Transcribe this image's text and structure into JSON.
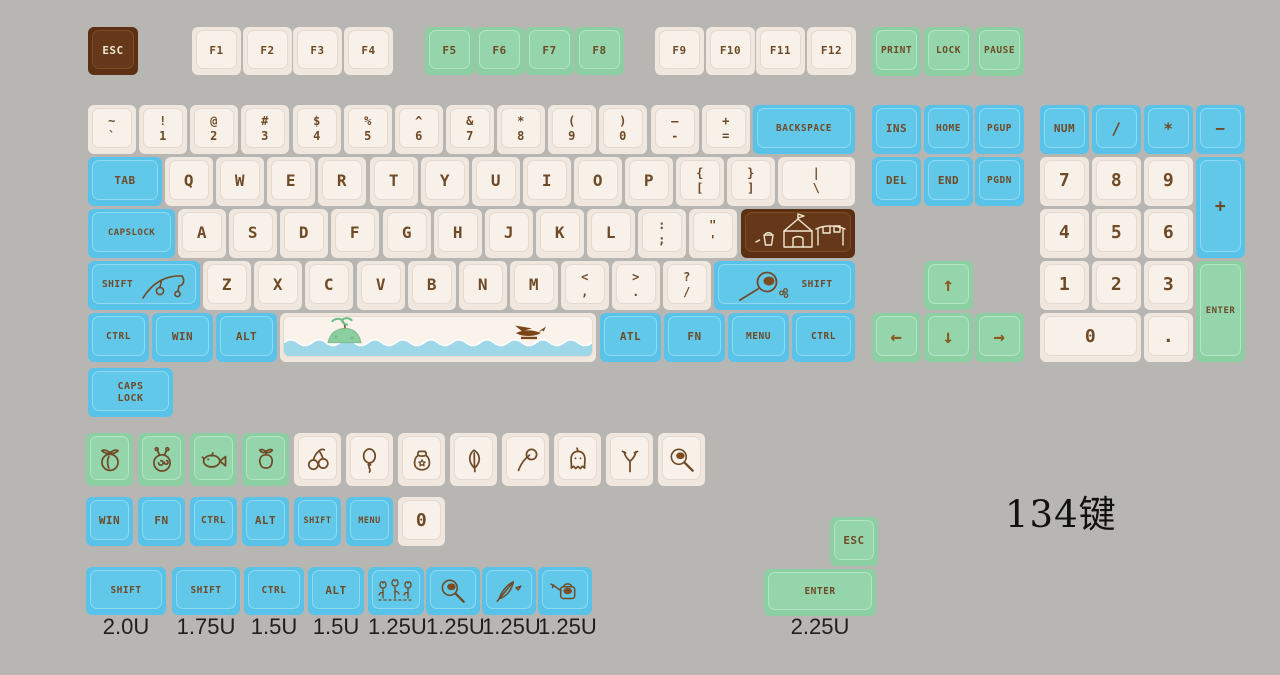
{
  "title": "134键",
  "palette": {
    "background": "#b8b6b3",
    "cream_key": "#f0e7df",
    "blue_key": "#58c2e8",
    "green_key": "#8bcfa2",
    "brown_key": "#5c3012",
    "legend_brown": "#6f4a26",
    "legend_cream": "#f0e5cf"
  },
  "keys": [
    {
      "n": "key-esc",
      "t": "ESC",
      "c": "brown",
      "x": 88,
      "y": 27,
      "w": 50,
      "h": 48
    },
    {
      "t": "F1",
      "c": "cream",
      "x": 192,
      "y": 27,
      "w": 49,
      "h": 48
    },
    {
      "t": "F2",
      "c": "cream",
      "x": 243,
      "y": 27,
      "w": 49,
      "h": 48
    },
    {
      "t": "F3",
      "c": "cream",
      "x": 293,
      "y": 27,
      "w": 49,
      "h": 48
    },
    {
      "t": "F4",
      "c": "cream",
      "x": 344,
      "y": 27,
      "w": 49,
      "h": 48
    },
    {
      "t": "F5",
      "c": "green",
      "x": 425,
      "y": 27,
      "w": 49,
      "h": 48
    },
    {
      "t": "F6",
      "c": "green",
      "x": 475,
      "y": 27,
      "w": 49,
      "h": 48
    },
    {
      "t": "F7",
      "c": "green",
      "x": 525,
      "y": 27,
      "w": 49,
      "h": 48
    },
    {
      "t": "F8",
      "c": "green",
      "x": 575,
      "y": 27,
      "w": 49,
      "h": 48
    },
    {
      "t": "F9",
      "c": "cream",
      "x": 655,
      "y": 27,
      "w": 49,
      "h": 48
    },
    {
      "t": "F10",
      "c": "cream",
      "x": 706,
      "y": 27,
      "w": 49,
      "h": 48
    },
    {
      "t": "F11",
      "c": "cream",
      "x": 756,
      "y": 27,
      "w": 49,
      "h": 48
    },
    {
      "t": "F12",
      "c": "cream",
      "x": 807,
      "y": 27,
      "w": 49,
      "h": 48
    },
    {
      "t": "PRINT",
      "c": "green",
      "x": 872,
      "y": 27,
      "w": 49,
      "h": 49
    },
    {
      "t": "LOCK",
      "c": "green",
      "x": 924,
      "y": 27,
      "w": 49,
      "h": 49
    },
    {
      "t": "PAUSE",
      "c": "green",
      "x": 975,
      "y": 27,
      "w": 49,
      "h": 49
    },
    {
      "n": "key-grave",
      "top": "~",
      "bot": "`",
      "c": "cream",
      "x": 88,
      "y": 105,
      "w": 48,
      "h": 49
    },
    {
      "n": "key-1",
      "top": "!",
      "bot": "1",
      "c": "cream",
      "x": 139,
      "y": 105,
      "w": 48,
      "h": 49
    },
    {
      "n": "key-2",
      "top": "@",
      "bot": "2",
      "c": "cream",
      "x": 190,
      "y": 105,
      "w": 48,
      "h": 49
    },
    {
      "n": "key-3",
      "top": "#",
      "bot": "3",
      "c": "cream",
      "x": 241,
      "y": 105,
      "w": 48,
      "h": 49
    },
    {
      "n": "key-4",
      "top": "$",
      "bot": "4",
      "c": "cream",
      "x": 293,
      "y": 105,
      "w": 48,
      "h": 49
    },
    {
      "n": "key-5",
      "top": "%",
      "bot": "5",
      "c": "cream",
      "x": 344,
      "y": 105,
      "w": 48,
      "h": 49
    },
    {
      "n": "key-6",
      "top": "^",
      "bot": "6",
      "c": "cream",
      "x": 395,
      "y": 105,
      "w": 48,
      "h": 49
    },
    {
      "n": "key-7",
      "top": "&",
      "bot": "7",
      "c": "cream",
      "x": 446,
      "y": 105,
      "w": 48,
      "h": 49
    },
    {
      "n": "key-8",
      "top": "*",
      "bot": "8",
      "c": "cream",
      "x": 497,
      "y": 105,
      "w": 48,
      "h": 49
    },
    {
      "n": "key-9",
      "top": "(",
      "bot": "9",
      "c": "cream",
      "x": 548,
      "y": 105,
      "w": 48,
      "h": 49
    },
    {
      "n": "key-0",
      "top": ")",
      "bot": "0",
      "c": "cream",
      "x": 599,
      "y": 105,
      "w": 48,
      "h": 49
    },
    {
      "n": "key-minus",
      "top": "–",
      "bot": "-",
      "c": "cream",
      "x": 651,
      "y": 105,
      "w": 48,
      "h": 49
    },
    {
      "n": "key-equals",
      "top": "+",
      "bot": "=",
      "c": "cream",
      "x": 702,
      "y": 105,
      "w": 48,
      "h": 49
    },
    {
      "t": "BACKSPACE",
      "c": "blue",
      "x": 753,
      "y": 105,
      "w": 102,
      "h": 49
    },
    {
      "t": "TAB",
      "c": "blue",
      "x": 88,
      "y": 157,
      "w": 74,
      "h": 49
    },
    {
      "t": "Q",
      "c": "cream",
      "x": 165,
      "y": 157,
      "w": 48,
      "h": 49
    },
    {
      "t": "W",
      "c": "cream",
      "x": 216,
      "y": 157,
      "w": 48,
      "h": 49
    },
    {
      "t": "E",
      "c": "cream",
      "x": 267,
      "y": 157,
      "w": 48,
      "h": 49
    },
    {
      "t": "R",
      "c": "cream",
      "x": 318,
      "y": 157,
      "w": 48,
      "h": 49
    },
    {
      "t": "T",
      "c": "cream",
      "x": 370,
      "y": 157,
      "w": 48,
      "h": 49
    },
    {
      "t": "Y",
      "c": "cream",
      "x": 421,
      "y": 157,
      "w": 48,
      "h": 49
    },
    {
      "t": "U",
      "c": "cream",
      "x": 472,
      "y": 157,
      "w": 48,
      "h": 49
    },
    {
      "t": "I",
      "c": "cream",
      "x": 523,
      "y": 157,
      "w": 48,
      "h": 49
    },
    {
      "t": "O",
      "c": "cream",
      "x": 574,
      "y": 157,
      "w": 48,
      "h": 49
    },
    {
      "t": "P",
      "c": "cream",
      "x": 625,
      "y": 157,
      "w": 48,
      "h": 49
    },
    {
      "n": "key-bracket-open",
      "top": "{",
      "bot": "[",
      "c": "cream",
      "x": 676,
      "y": 157,
      "w": 48,
      "h": 49
    },
    {
      "n": "key-bracket-close",
      "top": "}",
      "bot": "]",
      "c": "cream",
      "x": 727,
      "y": 157,
      "w": 48,
      "h": 49
    },
    {
      "n": "key-backslash",
      "top": "|",
      "bot": "\\",
      "c": "cream",
      "x": 778,
      "y": 157,
      "w": 77,
      "h": 49
    },
    {
      "t": "CAPSLOCK",
      "c": "blue",
      "x": 88,
      "y": 209,
      "w": 87,
      "h": 49,
      "fs": 9
    },
    {
      "t": "A",
      "c": "cream",
      "x": 178,
      "y": 209,
      "w": 48,
      "h": 49
    },
    {
      "t": "S",
      "c": "cream",
      "x": 229,
      "y": 209,
      "w": 48,
      "h": 49
    },
    {
      "t": "D",
      "c": "cream",
      "x": 280,
      "y": 209,
      "w": 48,
      "h": 49
    },
    {
      "t": "F",
      "c": "cream",
      "x": 331,
      "y": 209,
      "w": 48,
      "h": 49
    },
    {
      "t": "G",
      "c": "cream",
      "x": 383,
      "y": 209,
      "w": 48,
      "h": 49
    },
    {
      "t": "H",
      "c": "cream",
      "x": 434,
      "y": 209,
      "w": 48,
      "h": 49
    },
    {
      "t": "J",
      "c": "cream",
      "x": 485,
      "y": 209,
      "w": 48,
      "h": 49
    },
    {
      "t": "K",
      "c": "cream",
      "x": 536,
      "y": 209,
      "w": 48,
      "h": 49
    },
    {
      "t": "L",
      "c": "cream",
      "x": 587,
      "y": 209,
      "w": 48,
      "h": 49
    },
    {
      "n": "key-semicolon",
      "top": ":",
      "bot": ";",
      "c": "cream",
      "x": 638,
      "y": 209,
      "w": 48,
      "h": 49
    },
    {
      "n": "key-quote",
      "top": "\"",
      "bot": "'",
      "c": "cream",
      "x": 689,
      "y": 209,
      "w": 48,
      "h": 49
    },
    {
      "n": "key-enter-iso",
      "art": "house-scene",
      "c": "brown",
      "x": 741,
      "y": 209,
      "w": 114,
      "h": 49
    },
    {
      "n": "key-shift-left",
      "t": "SHIFT",
      "icon": "fishing-rod-icon",
      "c": "blue",
      "x": 88,
      "y": 261,
      "w": 112,
      "h": 49
    },
    {
      "t": "Z",
      "c": "cream",
      "x": 203,
      "y": 261,
      "w": 48,
      "h": 49
    },
    {
      "t": "X",
      "c": "cream",
      "x": 254,
      "y": 261,
      "w": 48,
      "h": 49
    },
    {
      "t": "C",
      "c": "cream",
      "x": 305,
      "y": 261,
      "w": 48,
      "h": 49
    },
    {
      "t": "V",
      "c": "cream",
      "x": 357,
      "y": 261,
      "w": 48,
      "h": 49
    },
    {
      "t": "B",
      "c": "cream",
      "x": 408,
      "y": 261,
      "w": 48,
      "h": 49
    },
    {
      "t": "N",
      "c": "cream",
      "x": 459,
      "y": 261,
      "w": 48,
      "h": 49
    },
    {
      "t": "M",
      "c": "cream",
      "x": 510,
      "y": 261,
      "w": 48,
      "h": 49
    },
    {
      "n": "key-comma",
      "top": "<",
      "bot": ",",
      "c": "cream",
      "x": 561,
      "y": 261,
      "w": 48,
      "h": 49
    },
    {
      "n": "key-period",
      "top": ">",
      "bot": ".",
      "c": "cream",
      "x": 612,
      "y": 261,
      "w": 48,
      "h": 49
    },
    {
      "n": "key-slash",
      "top": "?",
      "bot": "/",
      "c": "cream",
      "x": 663,
      "y": 261,
      "w": 48,
      "h": 49
    },
    {
      "n": "key-shift-right",
      "t": "SHIFT",
      "icon": "net-icon",
      "iconside": "left",
      "c": "blue",
      "x": 714,
      "y": 261,
      "w": 141,
      "h": 49
    },
    {
      "t": "CTRL",
      "c": "blue",
      "x": 88,
      "y": 313,
      "w": 61,
      "h": 49
    },
    {
      "t": "WIN",
      "c": "blue",
      "x": 152,
      "y": 313,
      "w": 61,
      "h": 49
    },
    {
      "t": "ALT",
      "c": "blue",
      "x": 216,
      "y": 313,
      "w": 61,
      "h": 49
    },
    {
      "n": "key-space",
      "art": "island-scene",
      "c": "cream",
      "x": 280,
      "y": 313,
      "w": 316,
      "h": 49
    },
    {
      "t": "ATL",
      "c": "blue",
      "x": 600,
      "y": 313,
      "w": 61,
      "h": 49
    },
    {
      "t": "FN",
      "c": "blue",
      "x": 664,
      "y": 313,
      "w": 61,
      "h": 49
    },
    {
      "t": "MENU",
      "c": "blue",
      "x": 728,
      "y": 313,
      "w": 61,
      "h": 49
    },
    {
      "t": "CTRL",
      "c": "blue",
      "x": 792,
      "y": 313,
      "w": 63,
      "h": 49
    },
    {
      "t": "INS",
      "c": "blue",
      "x": 872,
      "y": 105,
      "w": 49,
      "h": 49
    },
    {
      "t": "HOME",
      "c": "blue",
      "x": 924,
      "y": 105,
      "w": 49,
      "h": 49
    },
    {
      "t": "PGUP",
      "c": "blue",
      "x": 975,
      "y": 105,
      "w": 49,
      "h": 49
    },
    {
      "t": "DEL",
      "c": "blue",
      "x": 872,
      "y": 157,
      "w": 49,
      "h": 49
    },
    {
      "t": "END",
      "c": "blue",
      "x": 924,
      "y": 157,
      "w": 49,
      "h": 49
    },
    {
      "t": "PGDN",
      "c": "blue",
      "x": 975,
      "y": 157,
      "w": 49,
      "h": 49
    },
    {
      "n": "key-arrow-up",
      "t": "↑",
      "c": "green",
      "cls": "arrow",
      "x": 924,
      "y": 261,
      "w": 49,
      "h": 49,
      "fs": 19
    },
    {
      "n": "key-arrow-left",
      "t": "←",
      "c": "green",
      "cls": "arrow",
      "x": 872,
      "y": 313,
      "w": 49,
      "h": 49,
      "fs": 19
    },
    {
      "n": "key-arrow-down",
      "t": "↓",
      "c": "green",
      "cls": "arrow",
      "x": 924,
      "y": 313,
      "w": 49,
      "h": 49,
      "fs": 19
    },
    {
      "n": "key-arrow-right",
      "t": "→",
      "c": "green",
      "cls": "arrow",
      "x": 975,
      "y": 313,
      "w": 49,
      "h": 49,
      "fs": 19
    },
    {
      "t": "NUM",
      "c": "blue",
      "x": 1040,
      "y": 105,
      "w": 49,
      "h": 49
    },
    {
      "n": "key-numpad-slash",
      "t": "/",
      "c": "blue",
      "x": 1092,
      "y": 105,
      "w": 49,
      "h": 49
    },
    {
      "n": "key-numpad-star",
      "t": "*",
      "c": "blue",
      "x": 1144,
      "y": 105,
      "w": 49,
      "h": 49
    },
    {
      "n": "key-numpad-minus",
      "t": "−",
      "c": "blue",
      "x": 1196,
      "y": 105,
      "w": 49,
      "h": 49
    },
    {
      "n": "key-numpad-7",
      "t": "7",
      "c": "cream",
      "x": 1040,
      "y": 157,
      "w": 49,
      "h": 49,
      "fs": 18
    },
    {
      "n": "key-numpad-8",
      "t": "8",
      "c": "cream",
      "x": 1092,
      "y": 157,
      "w": 49,
      "h": 49,
      "fs": 18
    },
    {
      "n": "key-numpad-9",
      "t": "9",
      "c": "cream",
      "x": 1144,
      "y": 157,
      "w": 49,
      "h": 49,
      "fs": 18
    },
    {
      "n": "key-numpad-plus",
      "t": "+",
      "c": "blue",
      "x": 1196,
      "y": 157,
      "w": 49,
      "h": 101,
      "fs": 18
    },
    {
      "n": "key-numpad-4",
      "t": "4",
      "c": "cream",
      "x": 1040,
      "y": 209,
      "w": 49,
      "h": 49,
      "fs": 18
    },
    {
      "n": "key-numpad-5",
      "t": "5",
      "c": "cream",
      "x": 1092,
      "y": 209,
      "w": 49,
      "h": 49,
      "fs": 18
    },
    {
      "n": "key-numpad-6",
      "t": "6",
      "c": "cream",
      "x": 1144,
      "y": 209,
      "w": 49,
      "h": 49,
      "fs": 18
    },
    {
      "n": "key-numpad-1",
      "t": "1",
      "c": "cream",
      "x": 1040,
      "y": 261,
      "w": 49,
      "h": 49,
      "fs": 18
    },
    {
      "n": "key-numpad-2",
      "t": "2",
      "c": "cream",
      "x": 1092,
      "y": 261,
      "w": 49,
      "h": 49,
      "fs": 18
    },
    {
      "n": "key-numpad-3",
      "t": "3",
      "c": "cream",
      "x": 1144,
      "y": 261,
      "w": 49,
      "h": 49,
      "fs": 18
    },
    {
      "n": "key-numpad-enter",
      "t": "ENTER",
      "c": "green",
      "x": 1196,
      "y": 261,
      "w": 49,
      "h": 101,
      "fs": 9
    },
    {
      "n": "key-numpad-0",
      "t": "0",
      "c": "cream",
      "x": 1040,
      "y": 313,
      "w": 101,
      "h": 49,
      "fs": 18
    },
    {
      "n": "key-numpad-dot",
      "t": ".",
      "c": "cream",
      "x": 1144,
      "y": 313,
      "w": 49,
      "h": 49,
      "fs": 18
    },
    {
      "n": "key-caps-lock-alt",
      "top": "CAPS",
      "bot": "LOCK",
      "c": "blue",
      "x": 88,
      "y": 368,
      "w": 85,
      "h": 49,
      "fs": 10
    },
    {
      "n": "key-peach",
      "icon": "peach-icon",
      "c": "green",
      "x": 86,
      "y": 433,
      "w": 47,
      "h": 53
    },
    {
      "n": "key-turnip",
      "icon": "turnip-icon",
      "c": "green",
      "x": 138,
      "y": 433,
      "w": 47,
      "h": 53
    },
    {
      "n": "key-fish",
      "icon": "fish-icon",
      "c": "green",
      "x": 190,
      "y": 433,
      "w": 47,
      "h": 53
    },
    {
      "n": "key-apple",
      "icon": "apple-icon",
      "c": "green",
      "x": 242,
      "y": 433,
      "w": 47,
      "h": 53
    },
    {
      "n": "key-cherry",
      "icon": "cherry-icon",
      "c": "cream",
      "x": 294,
      "y": 433,
      "w": 47,
      "h": 53
    },
    {
      "n": "key-balloon",
      "icon": "balloon-icon",
      "c": "cream",
      "x": 346,
      "y": 433,
      "w": 47,
      "h": 53
    },
    {
      "n": "key-bell-bag",
      "icon": "bell-bag-icon",
      "c": "cream",
      "x": 398,
      "y": 433,
      "w": 47,
      "h": 53
    },
    {
      "n": "key-leaf",
      "icon": "leaf-icon",
      "c": "cream",
      "x": 450,
      "y": 433,
      "w": 47,
      "h": 53
    },
    {
      "n": "key-axe",
      "icon": "axe-icon",
      "c": "cream",
      "x": 502,
      "y": 433,
      "w": 47,
      "h": 53
    },
    {
      "n": "key-wisp",
      "icon": "wisp-icon",
      "c": "cream",
      "x": 554,
      "y": 433,
      "w": 47,
      "h": 53
    },
    {
      "n": "key-slingshot",
      "icon": "slingshot-icon",
      "c": "cream",
      "x": 606,
      "y": 433,
      "w": 47,
      "h": 53
    },
    {
      "n": "key-net-small",
      "icon": "pan-icon",
      "c": "cream",
      "x": 658,
      "y": 433,
      "w": 47,
      "h": 53
    },
    {
      "t": "WIN",
      "c": "blue",
      "x": 86,
      "y": 497,
      "w": 47,
      "h": 49
    },
    {
      "t": "FN",
      "c": "blue",
      "x": 138,
      "y": 497,
      "w": 47,
      "h": 49
    },
    {
      "t": "CTRL",
      "c": "blue",
      "x": 190,
      "y": 497,
      "w": 47,
      "h": 49
    },
    {
      "t": "ALT",
      "c": "blue",
      "x": 242,
      "y": 497,
      "w": 47,
      "h": 49
    },
    {
      "t": "SHIFT",
      "c": "blue",
      "x": 294,
      "y": 497,
      "w": 47,
      "h": 49,
      "fs": 8.5
    },
    {
      "t": "MENU",
      "c": "blue",
      "x": 346,
      "y": 497,
      "w": 47,
      "h": 49,
      "fs": 8.5
    },
    {
      "n": "key-0-single",
      "t": "0",
      "c": "cream",
      "x": 398,
      "y": 497,
      "w": 47,
      "h": 49,
      "fs": 18
    },
    {
      "n": "key-shift-2u",
      "t": "SHIFT",
      "c": "blue",
      "x": 86,
      "y": 567,
      "w": 80,
      "h": 48
    },
    {
      "n": "key-shift-175u",
      "t": "SHIFT",
      "c": "blue",
      "x": 172,
      "y": 567,
      "w": 68,
      "h": 48
    },
    {
      "n": "key-ctrl-15u",
      "t": "CTRL",
      "c": "blue",
      "x": 244,
      "y": 567,
      "w": 60,
      "h": 48
    },
    {
      "n": "key-alt-15u",
      "t": "ALT",
      "c": "blue",
      "x": 308,
      "y": 567,
      "w": 56,
      "h": 48
    },
    {
      "n": "key-flowers",
      "icon": "flowers-icon",
      "c": "blue",
      "x": 368,
      "y": 567,
      "w": 56,
      "h": 48
    },
    {
      "n": "key-pan",
      "icon": "pan-icon",
      "c": "blue",
      "x": 426,
      "y": 567,
      "w": 54,
      "h": 48
    },
    {
      "n": "key-feather",
      "icon": "feather-icon",
      "c": "blue",
      "x": 482,
      "y": 567,
      "w": 54,
      "h": 48
    },
    {
      "n": "key-watering-can",
      "icon": "watering-can-icon",
      "c": "blue",
      "x": 538,
      "y": 567,
      "w": 54,
      "h": 48
    },
    {
      "n": "key-esc-green",
      "t": "ESC",
      "c": "green",
      "x": 830,
      "y": 517,
      "w": 48,
      "h": 49
    },
    {
      "n": "key-enter-225u",
      "t": "ENTER",
      "c": "green",
      "x": 764,
      "y": 569,
      "w": 112,
      "h": 47
    }
  ],
  "size_labels": [
    {
      "x": 86,
      "w": 80,
      "t": "2.0U"
    },
    {
      "x": 172,
      "w": 68,
      "t": "1.75U"
    },
    {
      "x": 244,
      "w": 60,
      "t": "1.5U"
    },
    {
      "x": 308,
      "w": 56,
      "t": "1.5U"
    },
    {
      "x": 368,
      "w": 56,
      "t": "1.25U"
    },
    {
      "x": 426,
      "w": 54,
      "t": "1.25U"
    },
    {
      "x": 482,
      "w": 54,
      "t": "1.25U"
    },
    {
      "x": 538,
      "w": 54,
      "t": "1.25U"
    },
    {
      "x": 764,
      "w": 112,
      "t": "2.25U"
    }
  ],
  "size_label_y": 614,
  "title_pos": {
    "x": 1005,
    "y": 484
  }
}
